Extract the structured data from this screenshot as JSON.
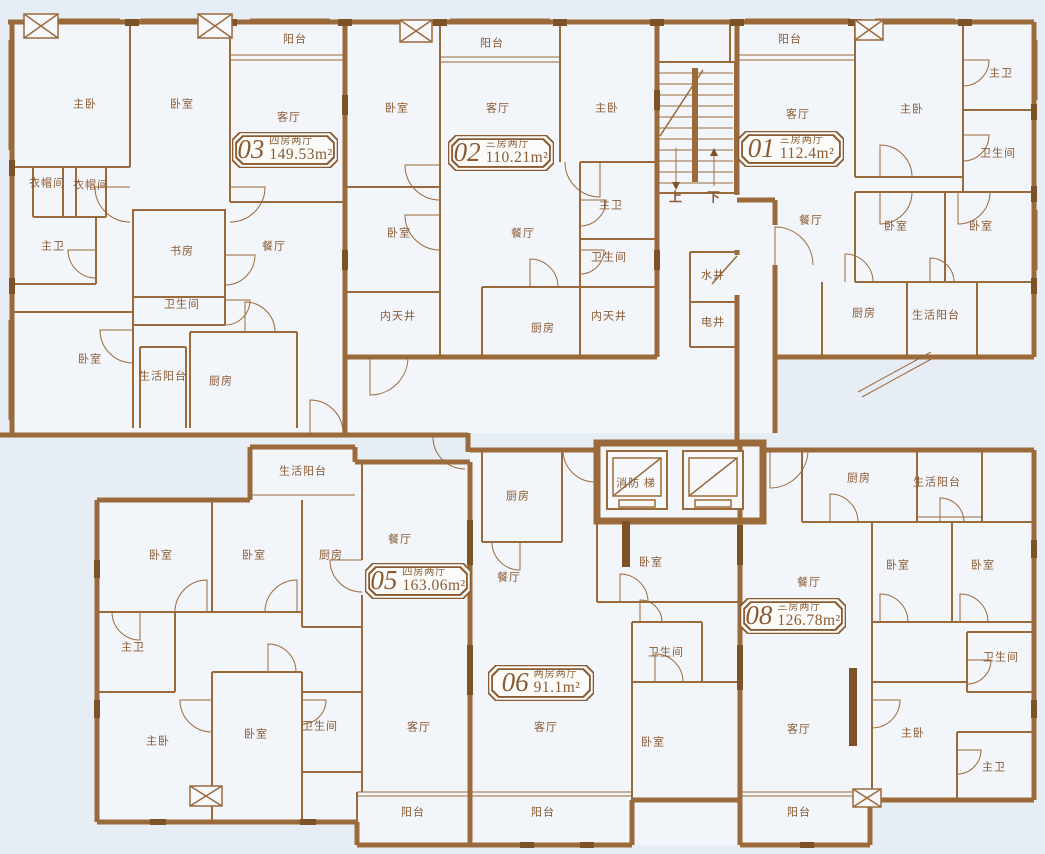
{
  "plan": {
    "background": "#e7edf5",
    "wall_color": "#9b6a3b",
    "pier_color": "#7d5226",
    "text_color": "#8a5a32"
  },
  "units": [
    {
      "id": "03",
      "layout": "四房两厅",
      "area": "149.53m²",
      "x": 232,
      "y": 132
    },
    {
      "id": "02",
      "layout": "三房两厅",
      "area": "110.21m²",
      "x": 448,
      "y": 135
    },
    {
      "id": "01",
      "layout": "三房两厅",
      "area": "112.4m²",
      "x": 738,
      "y": 131
    },
    {
      "id": "05",
      "layout": "四房两厅",
      "area": "163.06m²",
      "x": 365,
      "y": 563
    },
    {
      "id": "06",
      "layout": "两房两厅",
      "area": "91.1m²",
      "x": 488,
      "y": 665
    },
    {
      "id": "08",
      "layout": "三房两厅",
      "area": "126.78m²",
      "x": 740,
      "y": 598
    }
  ],
  "labels": [
    {
      "label": "阳台",
      "x": 295,
      "y": 40
    },
    {
      "label": "主卧",
      "x": 85,
      "y": 105
    },
    {
      "label": "卧室",
      "x": 182,
      "y": 105
    },
    {
      "label": "客厅",
      "x": 289,
      "y": 118
    },
    {
      "label": "衣帽间",
      "x": 47,
      "y": 184
    },
    {
      "label": "衣帽间",
      "x": 91,
      "y": 186
    },
    {
      "label": "主卫",
      "x": 53,
      "y": 247
    },
    {
      "label": "书房",
      "x": 182,
      "y": 252
    },
    {
      "label": "餐厅",
      "x": 274,
      "y": 247
    },
    {
      "label": "卫生间",
      "x": 182,
      "y": 305
    },
    {
      "label": "卧室",
      "x": 90,
      "y": 360
    },
    {
      "label": "生活阳台",
      "x": 163,
      "y": 377
    },
    {
      "label": "厨房",
      "x": 221,
      "y": 382
    },
    {
      "label": "阳台",
      "x": 492,
      "y": 44
    },
    {
      "label": "卧室",
      "x": 397,
      "y": 109
    },
    {
      "label": "客厅",
      "x": 498,
      "y": 109
    },
    {
      "label": "主卧",
      "x": 607,
      "y": 109
    },
    {
      "label": "主卫",
      "x": 611,
      "y": 206
    },
    {
      "label": "卧室",
      "x": 399,
      "y": 234
    },
    {
      "label": "餐厅",
      "x": 523,
      "y": 234
    },
    {
      "label": "卫生间",
      "x": 609,
      "y": 258
    },
    {
      "label": "内天井",
      "x": 398,
      "y": 317
    },
    {
      "label": "厨房",
      "x": 543,
      "y": 329
    },
    {
      "label": "内天井",
      "x": 609,
      "y": 317
    },
    {
      "label": "阳台",
      "x": 790,
      "y": 40
    },
    {
      "label": "客厅",
      "x": 798,
      "y": 115
    },
    {
      "label": "主卧",
      "x": 912,
      "y": 110
    },
    {
      "label": "主卫",
      "x": 1001,
      "y": 74
    },
    {
      "label": "卫生间",
      "x": 998,
      "y": 154
    },
    {
      "label": "餐厅",
      "x": 811,
      "y": 221
    },
    {
      "label": "卧室",
      "x": 896,
      "y": 227
    },
    {
      "label": "卧室",
      "x": 981,
      "y": 227
    },
    {
      "label": "厨房",
      "x": 864,
      "y": 314
    },
    {
      "label": "生活阳台",
      "x": 936,
      "y": 316
    },
    {
      "label": "上",
      "x": 676,
      "y": 197
    },
    {
      "label": "下",
      "x": 714,
      "y": 197
    },
    {
      "label": "水井",
      "x": 713,
      "y": 276
    },
    {
      "label": "电井",
      "x": 713,
      "y": 323
    },
    {
      "label": "消防 梯",
      "x": 636,
      "y": 484
    },
    {
      "label": "生活阳台",
      "x": 303,
      "y": 472
    },
    {
      "label": "卧室",
      "x": 161,
      "y": 556
    },
    {
      "label": "卧室",
      "x": 254,
      "y": 556
    },
    {
      "label": "厨房",
      "x": 331,
      "y": 556
    },
    {
      "label": "餐厅",
      "x": 400,
      "y": 540
    },
    {
      "label": "主卫",
      "x": 133,
      "y": 648
    },
    {
      "label": "主卧",
      "x": 158,
      "y": 742
    },
    {
      "label": "卧室",
      "x": 256,
      "y": 735
    },
    {
      "label": "卫生间",
      "x": 320,
      "y": 727
    },
    {
      "label": "客厅",
      "x": 419,
      "y": 728
    },
    {
      "label": "阳台",
      "x": 413,
      "y": 813
    },
    {
      "label": "厨房",
      "x": 518,
      "y": 497
    },
    {
      "label": "餐厅",
      "x": 509,
      "y": 578
    },
    {
      "label": "卧室",
      "x": 651,
      "y": 563
    },
    {
      "label": "卫生间",
      "x": 666,
      "y": 653
    },
    {
      "label": "客厅",
      "x": 546,
      "y": 728
    },
    {
      "label": "卧室",
      "x": 653,
      "y": 743
    },
    {
      "label": "阳台",
      "x": 543,
      "y": 813
    },
    {
      "label": "厨房",
      "x": 859,
      "y": 479
    },
    {
      "label": "生活阳台",
      "x": 937,
      "y": 483
    },
    {
      "label": "餐厅",
      "x": 809,
      "y": 583
    },
    {
      "label": "卧室",
      "x": 898,
      "y": 566
    },
    {
      "label": "卧室",
      "x": 983,
      "y": 566
    },
    {
      "label": "卫生间",
      "x": 1001,
      "y": 658
    },
    {
      "label": "客厅",
      "x": 799,
      "y": 730
    },
    {
      "label": "主卧",
      "x": 913,
      "y": 734
    },
    {
      "label": "主卫",
      "x": 994,
      "y": 768
    },
    {
      "label": "阳台",
      "x": 799,
      "y": 813
    }
  ]
}
